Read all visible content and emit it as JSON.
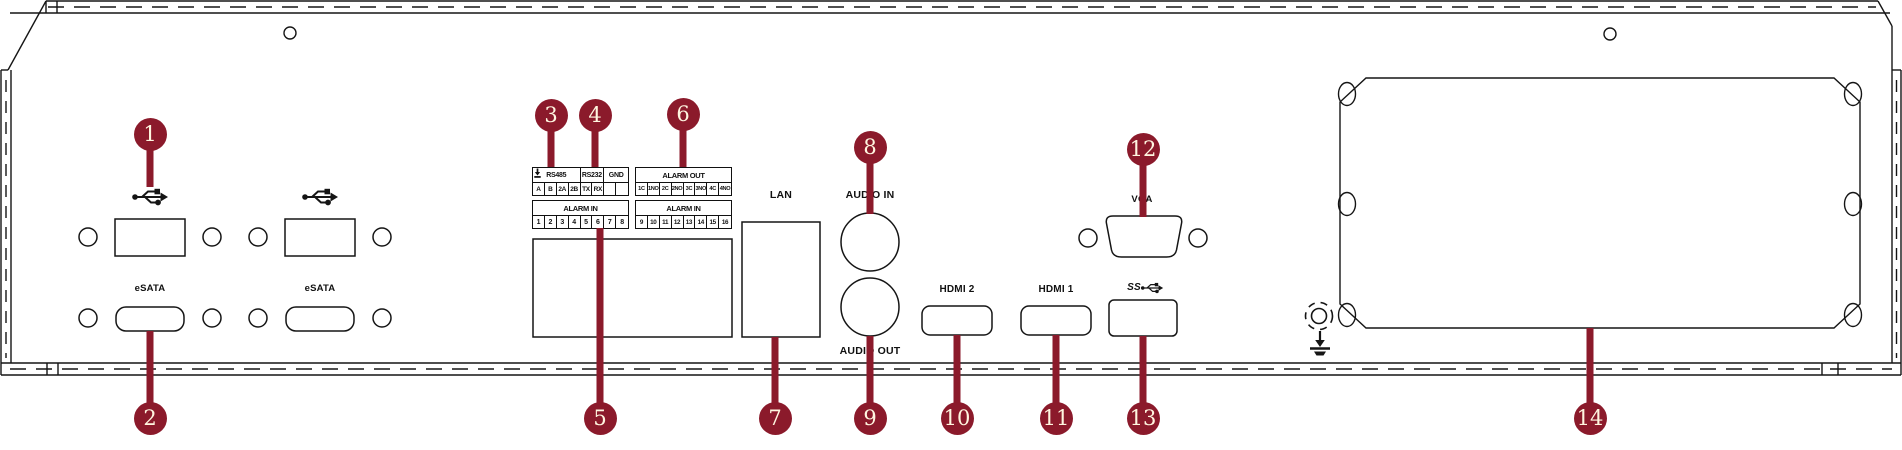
{
  "colors": {
    "callout_red": "#8B1A2B",
    "callout_number_text": "#FFF6E0",
    "line_ink": "#151515",
    "background": "#FFFFFF"
  },
  "callouts": [
    {
      "n": "1",
      "target": "usb-port"
    },
    {
      "n": "2",
      "target": "esata-port"
    },
    {
      "n": "3",
      "target": "rs485-terminals"
    },
    {
      "n": "4",
      "target": "rs232-terminals"
    },
    {
      "n": "5",
      "target": "alarm-in-terminals"
    },
    {
      "n": "6",
      "target": "alarm-out-terminals"
    },
    {
      "n": "7",
      "target": "lan-port"
    },
    {
      "n": "8",
      "target": "audio-in-jack"
    },
    {
      "n": "9",
      "target": "audio-out-jack"
    },
    {
      "n": "10",
      "target": "hdmi-2-port"
    },
    {
      "n": "11",
      "target": "hdmi-1-port"
    },
    {
      "n": "12",
      "target": "vga-port"
    },
    {
      "n": "13",
      "target": "usb3-port"
    },
    {
      "n": "14",
      "target": "power-supply"
    }
  ],
  "labels": {
    "esata_1": "eSATA",
    "esata_2": "eSATA",
    "lan": "LAN",
    "audio_in": "AUDIO IN",
    "audio_out": "AUDIO OUT",
    "hdmi_2": "HDMI 2",
    "hdmi_1": "HDMI 1",
    "vga": "VGA",
    "usb3_ss": "SS"
  },
  "terminal": {
    "serial": {
      "headers": [
        {
          "label": "RS485",
          "span": 4
        },
        {
          "label": "RS232",
          "span": 2
        },
        {
          "label": "GND",
          "span": 2
        }
      ],
      "cells": [
        "A",
        "B",
        "2A",
        "2B",
        "TX",
        "RX"
      ]
    },
    "alarm_out": {
      "header": "ALARM OUT",
      "cells": [
        "1C",
        "1NO",
        "2C",
        "2NO",
        "3C",
        "3NO",
        "4C",
        "4NO"
      ]
    },
    "alarm_in_left": {
      "header": "ALARM IN",
      "cells": [
        "1",
        "2",
        "3",
        "4",
        "5",
        "6",
        "7",
        "8"
      ]
    },
    "alarm_in_right": {
      "header": "ALARM IN",
      "cells": [
        "9",
        "10",
        "11",
        "12",
        "13",
        "14",
        "15",
        "16"
      ]
    }
  },
  "icons": {
    "usb2": "usb-trident-icon",
    "usb3": "usb3-ss-trident-icon",
    "ground_terminal": "earth-ground-icon",
    "ground_screw": "earth-ground-icon"
  }
}
